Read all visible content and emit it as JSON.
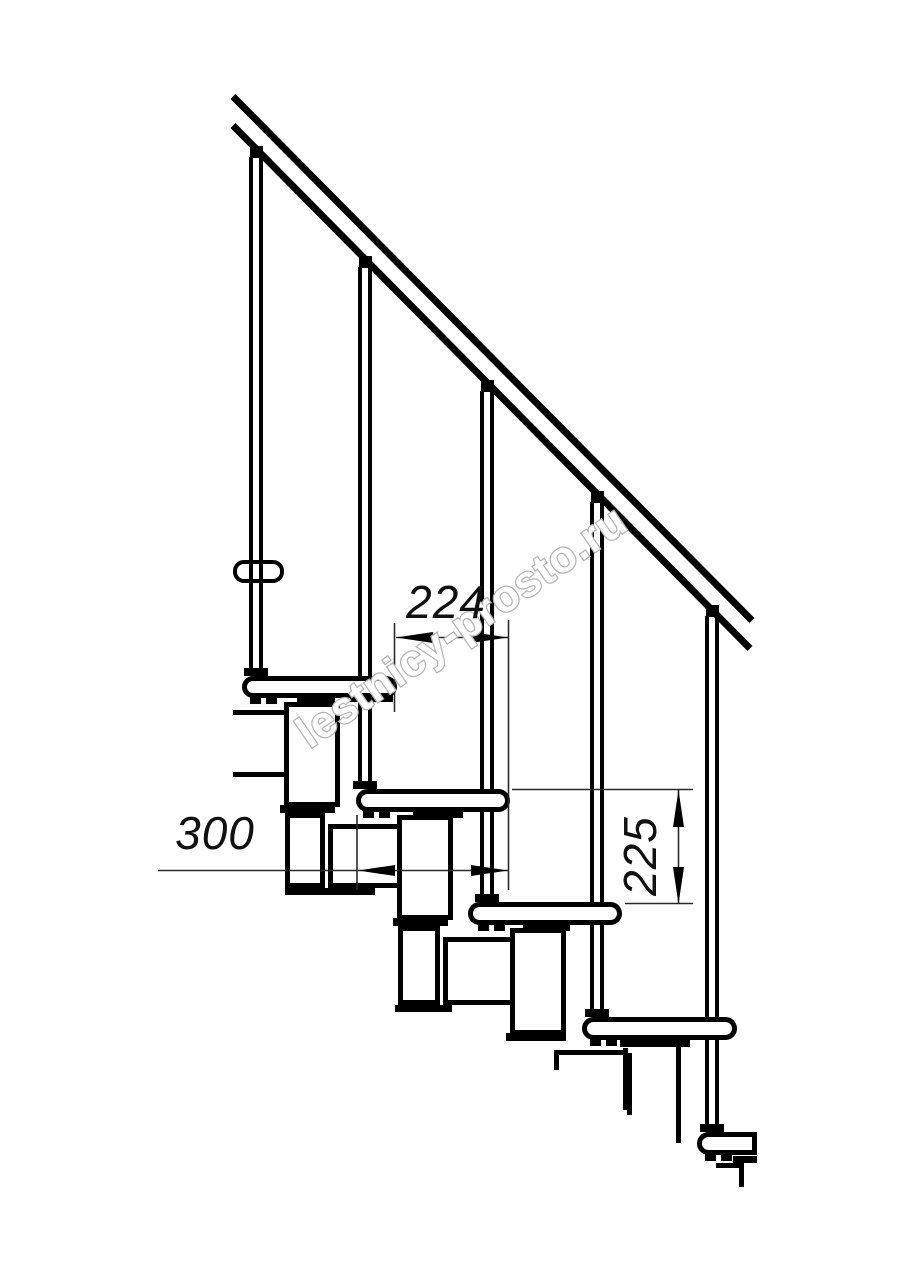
{
  "drawing": {
    "type": "staircase-section-technical-drawing",
    "dimensions": {
      "step_run": "224",
      "tread_length": "300",
      "step_rise": "225"
    },
    "watermark": {
      "text": "lestnicy-prosto.ru"
    }
  }
}
